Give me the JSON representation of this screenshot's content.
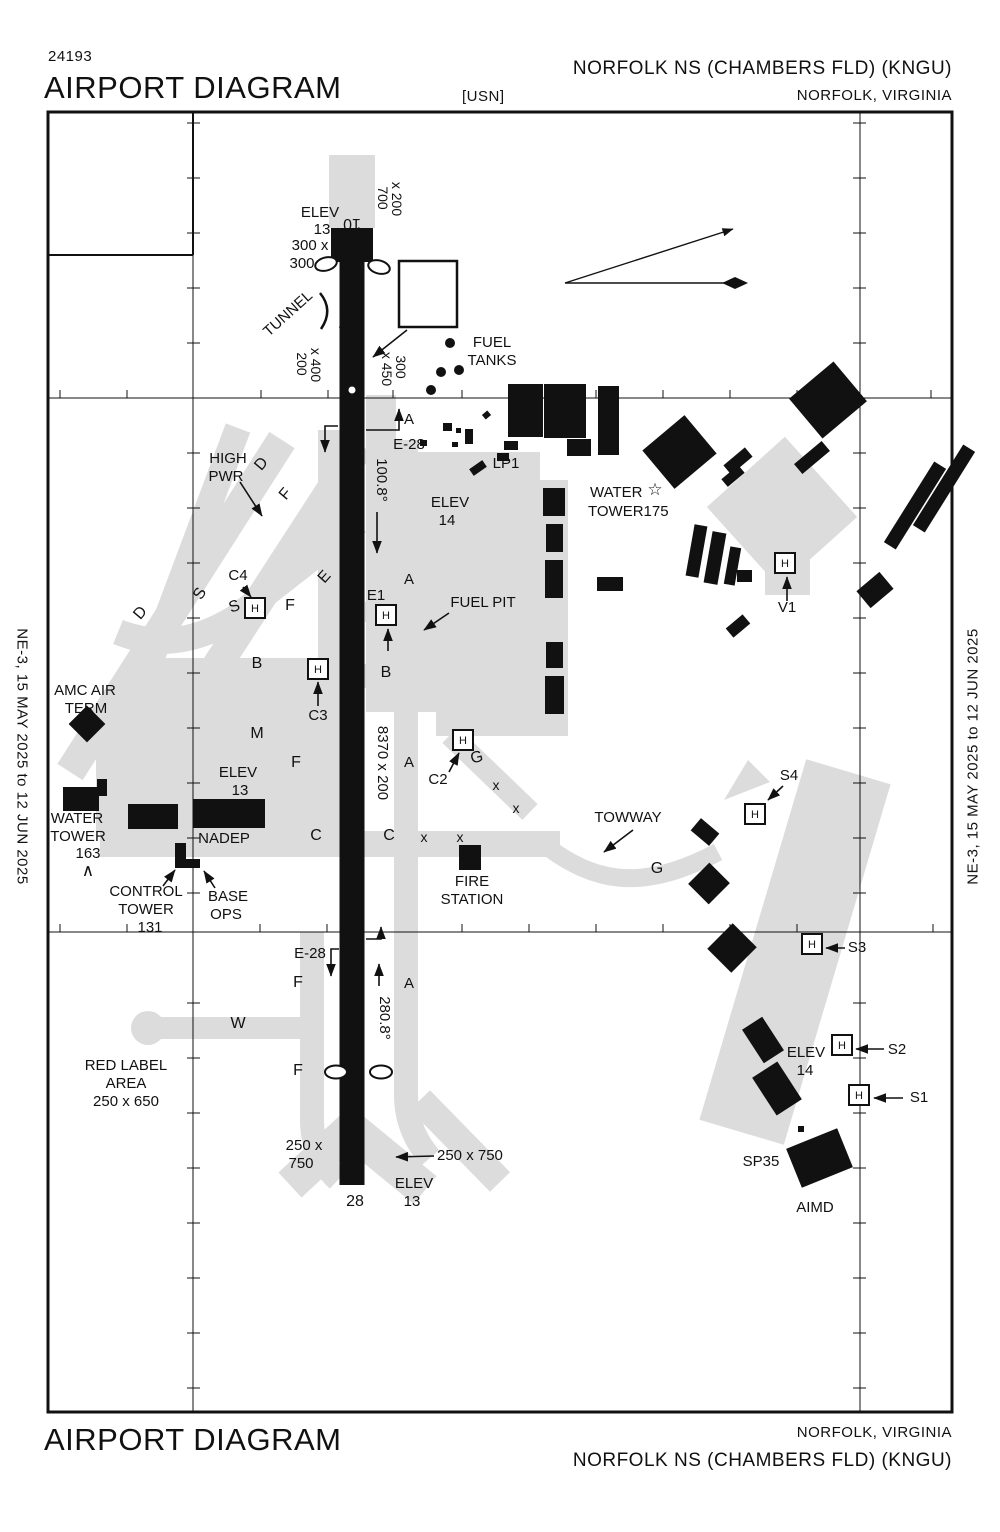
{
  "header": {
    "chart_number": "24193",
    "title": "AIRPORT DIAGRAM",
    "usn": "[USN]",
    "airport": "NORFOLK NS (CHAMBERS FLD)  (KNGU)",
    "city": "NORFOLK, VIRGINIA"
  },
  "footer": {
    "title": "AIRPORT DIAGRAM",
    "city": "NORFOLK, VIRGINIA",
    "airport": "NORFOLK NS (CHAMBERS FLD)  (KNGU)"
  },
  "margins": {
    "left": "NE-3,  15 MAY 2025  to  12 JUN 2025",
    "right": "NE-3,  15 MAY 2025  to  12 JUN 2025"
  },
  "comm": {
    "lines": [
      "ATIS",
      "118.425  338.225",
      "CHAMBERS TOWER",
      "124.3  379.15",
      "GND CON",
      "121.8  370.85",
      "CLNC DEL",
      "120.7  339.8"
    ]
  },
  "variation": {
    "date": "JUNE 2023",
    "rate_label": "ANNUAL RATE OF CHANGE",
    "rate": "0.0°W",
    "var_label": "VAR  10.8° W"
  },
  "field_elev": {
    "l1": "FIELD",
    "l2": "ELEV",
    "l3": "15"
  },
  "runway_notes": [
    "Rwy 10-28",
    "PCN 79 R/B/W/T",
    "Rwy 10 ldg 8071’",
    "Rwy 28 ldg 7375’"
  ],
  "grid": {
    "lon1": "76°18’W",
    "lon2": "76°17’W",
    "lat1": "36° 56’N",
    "lat2": "36° 57’N"
  },
  "helipad_label": "H",
  "helipads": [
    {
      "x": 255,
      "y": 608
    },
    {
      "x": 386,
      "y": 615
    },
    {
      "x": 318,
      "y": 669
    },
    {
      "x": 463,
      "y": 740
    },
    {
      "x": 785,
      "y": 563
    },
    {
      "x": 755,
      "y": 814
    },
    {
      "x": 812,
      "y": 944
    },
    {
      "x": 842,
      "y": 1045
    },
    {
      "x": 859,
      "y": 1095
    }
  ],
  "map_labels": [
    {
      "t": "ELEV",
      "x": 320,
      "y": 217
    },
    {
      "t": "13",
      "x": 322,
      "y": 234
    },
    {
      "t": "10",
      "x": 352,
      "y": 219,
      "r": 180,
      "s": 16
    },
    {
      "t": "700",
      "x": 378,
      "y": 198,
      "r": 90,
      "s": 14
    },
    {
      "t": "x 200",
      "x": 392,
      "y": 199,
      "r": 90,
      "s": 14
    },
    {
      "t": "300 x",
      "x": 310,
      "y": 250
    },
    {
      "t": "300",
      "x": 302,
      "y": 268
    },
    {
      "t": "TUNNEL",
      "x": 291,
      "y": 317,
      "r": -42
    },
    {
      "t": "200",
      "x": 297,
      "y": 364,
      "r": 90,
      "s": 14
    },
    {
      "t": "x 400",
      "x": 311,
      "y": 365,
      "r": 90,
      "s": 14
    },
    {
      "t": "x 450",
      "x": 382,
      "y": 369,
      "r": 90,
      "s": 14
    },
    {
      "t": "300",
      "x": 396,
      "y": 367,
      "r": 90,
      "s": 14
    },
    {
      "t": "FUEL",
      "x": 492,
      "y": 347
    },
    {
      "t": "TANKS",
      "x": 492,
      "y": 365
    },
    {
      "t": "A",
      "x": 409,
      "y": 424
    },
    {
      "t": "E-28",
      "x": 409,
      "y": 449
    },
    {
      "t": "100.8°",
      "x": 377,
      "y": 480,
      "r": 90
    },
    {
      "t": "LP1",
      "x": 506,
      "y": 468
    },
    {
      "t": "ELEV",
      "x": 450,
      "y": 507
    },
    {
      "t": "14",
      "x": 447,
      "y": 525
    },
    {
      "t": "WATER",
      "x": 590,
      "y": 497,
      "a": "start"
    },
    {
      "t": "☆",
      "x": 655,
      "y": 495,
      "s": 17
    },
    {
      "t": "TOWER175",
      "x": 588,
      "y": 516,
      "a": "start"
    },
    {
      "t": "V1",
      "x": 787,
      "y": 612
    },
    {
      "t": "HIGH",
      "x": 228,
      "y": 463
    },
    {
      "t": "PWR",
      "x": 226,
      "y": 481
    },
    {
      "t": "D",
      "x": 265,
      "y": 467,
      "r": -50,
      "s": 16
    },
    {
      "t": "F",
      "x": 289,
      "y": 497,
      "r": -50,
      "s": 16
    },
    {
      "t": "E",
      "x": 328,
      "y": 580,
      "r": -48,
      "s": 16
    },
    {
      "t": "D",
      "x": 144,
      "y": 616,
      "r": -50,
      "s": 16
    },
    {
      "t": "S",
      "x": 204,
      "y": 596,
      "r": -60,
      "s": 16
    },
    {
      "t": "S",
      "x": 236,
      "y": 611,
      "r": -20,
      "s": 16
    },
    {
      "t": "C4",
      "x": 238,
      "y": 580
    },
    {
      "t": "F",
      "x": 290,
      "y": 610,
      "s": 16
    },
    {
      "t": "E1",
      "x": 376,
      "y": 600
    },
    {
      "t": "B",
      "x": 257,
      "y": 668,
      "s": 16
    },
    {
      "t": "B",
      "x": 386,
      "y": 677,
      "s": 16
    },
    {
      "t": "C3",
      "x": 318,
      "y": 720
    },
    {
      "t": "M",
      "x": 257,
      "y": 738,
      "s": 16
    },
    {
      "t": "F",
      "x": 296,
      "y": 767,
      "s": 16
    },
    {
      "t": "A",
      "x": 409,
      "y": 584
    },
    {
      "t": "ELEV",
      "x": 238,
      "y": 777
    },
    {
      "t": "13",
      "x": 240,
      "y": 795
    },
    {
      "t": "FUEL PIT",
      "x": 483,
      "y": 607
    },
    {
      "t": "AMC AIR",
      "x": 85,
      "y": 695
    },
    {
      "t": "TERM",
      "x": 86,
      "y": 713
    },
    {
      "t": "WATER",
      "x": 77,
      "y": 823
    },
    {
      "t": "TOWER",
      "x": 78,
      "y": 841
    },
    {
      "t": "163",
      "x": 88,
      "y": 858
    },
    {
      "t": "∧",
      "x": 88,
      "y": 876,
      "s": 17
    },
    {
      "t": "NADEP",
      "x": 224,
      "y": 843
    },
    {
      "t": "CONTROL",
      "x": 146,
      "y": 896
    },
    {
      "t": "TOWER",
      "x": 146,
      "y": 914
    },
    {
      "t": "131",
      "x": 150,
      "y": 932
    },
    {
      "t": "BASE",
      "x": 228,
      "y": 901
    },
    {
      "t": "OPS",
      "x": 226,
      "y": 919
    },
    {
      "t": "C",
      "x": 316,
      "y": 840,
      "s": 16
    },
    {
      "t": "C",
      "x": 389,
      "y": 840,
      "s": 16
    },
    {
      "t": "x",
      "x": 424,
      "y": 842,
      "s": 14
    },
    {
      "t": "x",
      "x": 460,
      "y": 842,
      "s": 14
    },
    {
      "t": "x",
      "x": 496,
      "y": 790,
      "s": 14
    },
    {
      "t": "x",
      "x": 516,
      "y": 813,
      "s": 14
    },
    {
      "t": "G",
      "x": 478,
      "y": 762,
      "s": 16,
      "r": -15
    },
    {
      "t": "C2",
      "x": 438,
      "y": 784
    },
    {
      "t": "FIRE",
      "x": 472,
      "y": 886
    },
    {
      "t": "STATION",
      "x": 472,
      "y": 904
    },
    {
      "t": "TOWWAY",
      "x": 628,
      "y": 822
    },
    {
      "t": "G",
      "x": 657,
      "y": 873,
      "s": 16
    },
    {
      "t": "8370 x 200",
      "x": 378,
      "y": 763,
      "r": 90
    },
    {
      "t": "A",
      "x": 409,
      "y": 767
    },
    {
      "t": "S4",
      "x": 789,
      "y": 780
    },
    {
      "t": "S3",
      "x": 857,
      "y": 952
    },
    {
      "t": "ELEV",
      "x": 806,
      "y": 1057
    },
    {
      "t": "14",
      "x": 805,
      "y": 1075
    },
    {
      "t": "S2",
      "x": 897,
      "y": 1054
    },
    {
      "t": "S1",
      "x": 919,
      "y": 1102
    },
    {
      "t": "SP35",
      "x": 761,
      "y": 1166
    },
    {
      "t": "AIMD",
      "x": 815,
      "y": 1212
    },
    {
      "t": "E-28",
      "x": 310,
      "y": 958
    },
    {
      "t": "F",
      "x": 298,
      "y": 987,
      "s": 16
    },
    {
      "t": "280.8°",
      "x": 380,
      "y": 1018,
      "r": 90
    },
    {
      "t": "A",
      "x": 409,
      "y": 988
    },
    {
      "t": "W",
      "x": 238,
      "y": 1028,
      "s": 16
    },
    {
      "t": "F",
      "x": 298,
      "y": 1075,
      "s": 16
    },
    {
      "t": "RED LABEL",
      "x": 126,
      "y": 1070
    },
    {
      "t": "AREA",
      "x": 126,
      "y": 1088
    },
    {
      "t": "250 x 650",
      "x": 126,
      "y": 1106
    },
    {
      "t": "250 x",
      "x": 304,
      "y": 1150
    },
    {
      "t": "750",
      "x": 301,
      "y": 1168
    },
    {
      "t": "250  x 750",
      "x": 437,
      "y": 1160,
      "a": "start"
    },
    {
      "t": "28",
      "x": 355,
      "y": 1206,
      "s": 16
    },
    {
      "t": "ELEV",
      "x": 414,
      "y": 1188
    },
    {
      "t": "13",
      "x": 412,
      "y": 1206
    }
  ]
}
